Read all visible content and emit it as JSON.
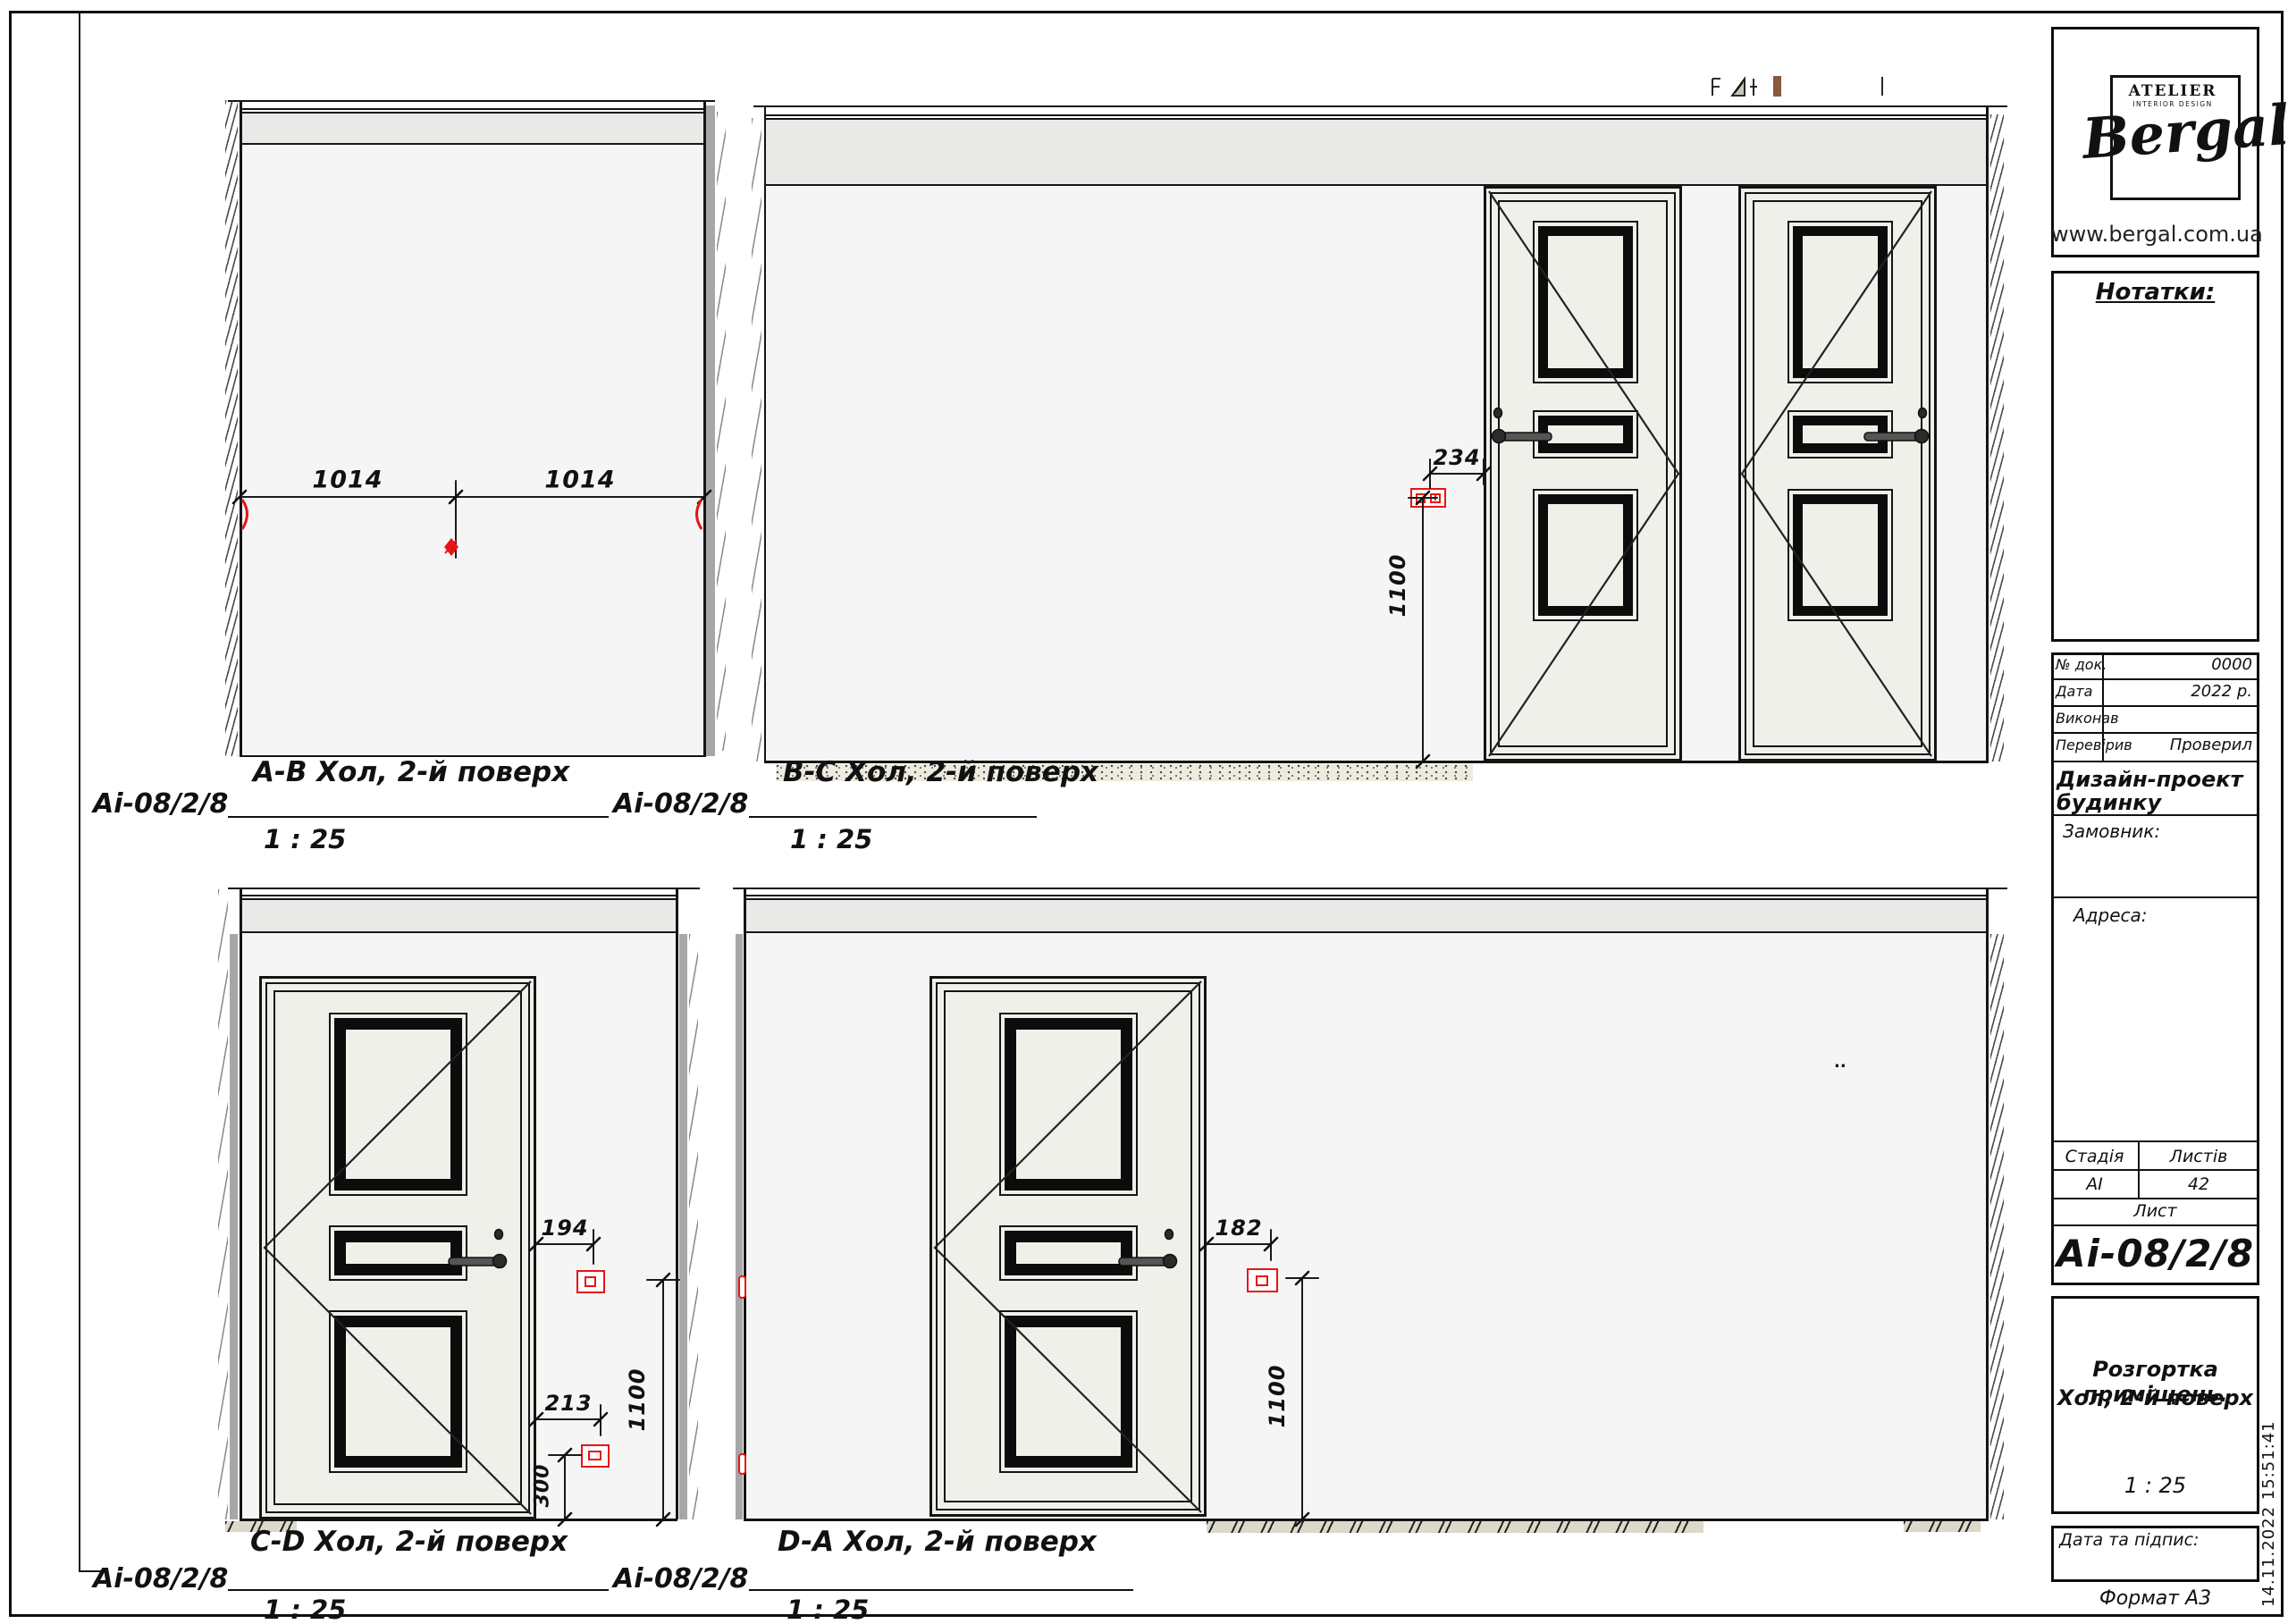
{
  "page": {
    "format_label": "Формат А3",
    "timestamp": "14.11.2022 15:51:41"
  },
  "brand": {
    "atelier": "ATELIER",
    "atelier_sub": "INTERIOR DESIGN",
    "name": "Bergal",
    "website": "www.bergal.com.ua"
  },
  "title_block": {
    "notes_label": "Нотатки:",
    "rows": [
      {
        "label": "№ док.",
        "value": "0000"
      },
      {
        "label": "Дата",
        "value": "2022 р."
      },
      {
        "label": "Виконав",
        "value": ""
      },
      {
        "label": "Перевірив",
        "value": "Проверил"
      }
    ],
    "project_title_1": "Дизайн-проект",
    "project_title_2": "будинку",
    "client_label": "Замовник:",
    "address_label": "Адреса:",
    "stage_header": "Стадія",
    "sheets_header": "Листів",
    "stage_value": "АІ",
    "sheets_value": "42",
    "sheet_label": "Лист",
    "sheet_code": "Аі-08/2/8",
    "drawing_title_1": "Розгортка приміщень.",
    "drawing_title_2": "Хол, 2-й поверх",
    "drawing_scale": "1 : 25",
    "sign_label": "Дата та підпис:"
  },
  "views": {
    "ab": {
      "title": "А-В Хол, 2-й поверх",
      "scale": "1 : 25",
      "ref_left": "Аі-08/2/8",
      "ref_right": "Аі-08/2/8",
      "dim_left": "1014",
      "dim_right": "1014"
    },
    "bc": {
      "title": "В-С Хол, 2-й поверх",
      "scale": "1 : 25",
      "dim_offset": "234",
      "dim_height": "1100"
    },
    "cd": {
      "title": "С-D Хол, 2-й поверх",
      "scale": "1 : 25",
      "ref_left": "Аі-08/2/8",
      "ref_right": "Аі-08/2/8",
      "dim_switch": "194",
      "dim_socket": "213",
      "dim_socket_h": "300",
      "dim_height": "1100"
    },
    "da": {
      "title": "D-А Хол, 2-й поверх",
      "scale": "1 : 25",
      "dim_switch": "182",
      "dim_height": "1100",
      "mark": ".."
    }
  }
}
